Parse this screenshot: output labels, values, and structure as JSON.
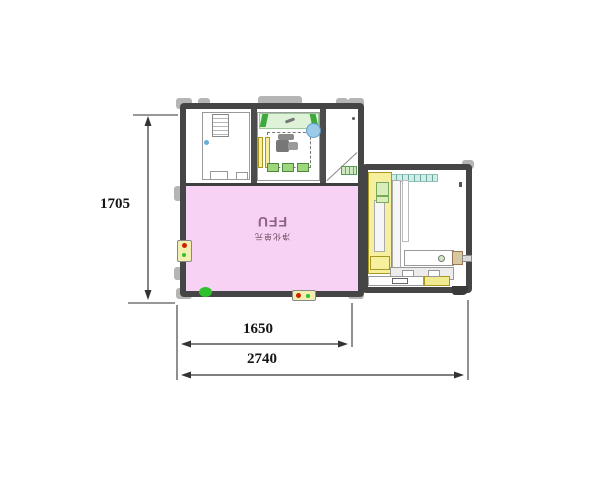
{
  "drawing": {
    "type": "equipment-layout-top-view",
    "machine": {
      "ffu_label": "FFU",
      "ffu_sublabel": "净化单元"
    },
    "dimensions": {
      "height_mm": "1705",
      "inner_width_mm": "1650",
      "overall_width_mm": "2740"
    },
    "colors": {
      "ffu_zone": "#f8d2f5",
      "frame": "#454545",
      "bracket": "#b5b5b5",
      "clean_strip_green": "#def2d8",
      "clamp_green": "#3da93d",
      "component_yellow": "#f5ef9e",
      "conveyor_teal": "#cfeee8",
      "indicator_red": "#cc2200",
      "indicator_green": "#2ec22e",
      "sensor_blue": "#9ccbe8"
    }
  }
}
